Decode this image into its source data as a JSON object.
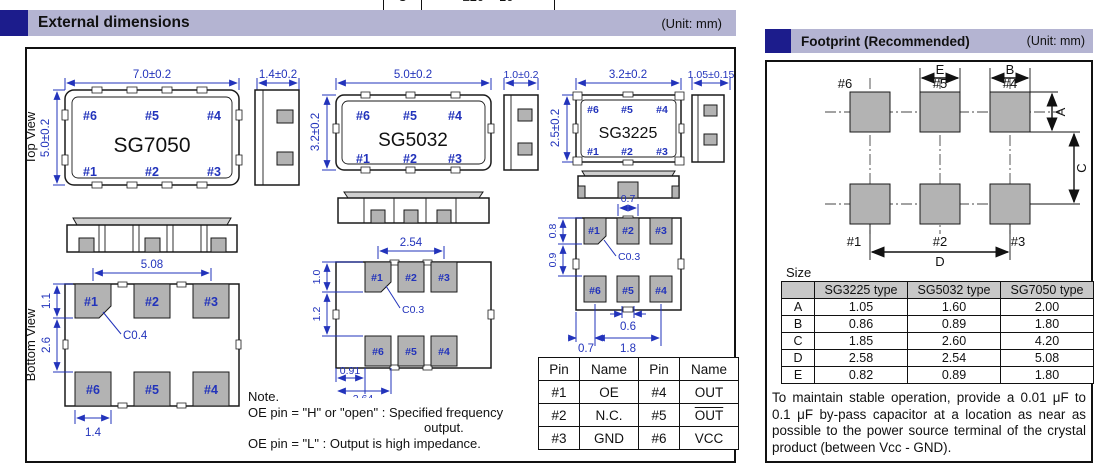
{
  "frag": {
    "c1": "C",
    "c2": "±20 × 10"
  },
  "ext": {
    "title": "External dimensions",
    "unit": "(Unit: mm)",
    "top_view": "Top View",
    "bottom_view": "Bottom View",
    "sg7050": {
      "name": "SG7050",
      "w": "7.0±0.2",
      "h": "5.0±0.2",
      "side": "1.4±0.2",
      "pins_top": [
        "#6",
        "#5",
        "#4"
      ],
      "pins_bot": [
        "#1",
        "#2",
        "#3"
      ],
      "bv": {
        "pitch": "5.08",
        "pad_h": "1.1",
        "gap": "2.6",
        "pad_w": "1.4",
        "chamfer": "C0.4",
        "row1": [
          "#1",
          "#2",
          "#3"
        ],
        "row2": [
          "#6",
          "#5",
          "#4"
        ]
      }
    },
    "sg5032": {
      "name": "SG5032",
      "w": "5.0±0.2",
      "h": "3.2±0.2",
      "side": "1.0±0.2",
      "pins_top": [
        "#6",
        "#5",
        "#4"
      ],
      "pins_bot": [
        "#1",
        "#2",
        "#3"
      ],
      "bv": {
        "pitch": "2.54",
        "pad_h": "1.0",
        "gap": "1.2",
        "d1": "0.91",
        "d2": "2.64",
        "chamfer": "C0.3",
        "row1": [
          "#1",
          "#2",
          "#3"
        ],
        "row2": [
          "#6",
          "#5",
          "#4"
        ]
      }
    },
    "sg3225": {
      "name": "SG3225",
      "w": "3.2±0.2",
      "h": "2.5±0.2",
      "side": "1.05±0.15",
      "pins_top": [
        "#6",
        "#5",
        "#4"
      ],
      "pins_bot": [
        "#1",
        "#2",
        "#3"
      ],
      "bv": {
        "notch_top": "0.7",
        "pad_h": "0.8",
        "gap": "0.9",
        "chamfer": "C0.3",
        "notch_bot": "0.6",
        "d_left": "0.7",
        "d_right": "1.8",
        "row1": [
          "#1",
          "#2",
          "#3"
        ],
        "row2": [
          "#6",
          "#5",
          "#4"
        ]
      }
    },
    "note": {
      "l1": "Note.",
      "l2": "OE pin = \"H\" or \"open\" : Specified frequency",
      "l3": "output.",
      "l4": "OE pin = \"L\" : Output is high impedance."
    },
    "pin_table": {
      "headers": [
        "Pin",
        "Name",
        "Pin",
        "Name"
      ],
      "rows": [
        [
          "#1",
          "OE",
          "#4",
          "OUT"
        ],
        [
          "#2",
          "N.C.",
          "#5",
          "OUT"
        ],
        [
          "#3",
          "GND",
          "#6",
          "VCC"
        ]
      ]
    }
  },
  "fp": {
    "title": "Footprint (Recommended)",
    "unit": "(Unit: mm)",
    "pads_top": [
      "#6",
      "#5",
      "#4"
    ],
    "pads_bot": [
      "#1",
      "#2",
      "#3"
    ],
    "dims": {
      "a": "A",
      "b": "B",
      "c": "C",
      "d": "D",
      "e": "E"
    },
    "size_label": "Size",
    "table": {
      "headers": [
        "",
        "SG3225 type",
        "SG5032 type",
        "SG7050 type"
      ],
      "rows": [
        [
          "A",
          "1.05",
          "1.60",
          "2.00"
        ],
        [
          "B",
          "0.86",
          "0.89",
          "1.80"
        ],
        [
          "C",
          "1.85",
          "2.60",
          "4.20"
        ],
        [
          "D",
          "2.58",
          "2.54",
          "5.08"
        ],
        [
          "E",
          "0.82",
          "0.89",
          "1.80"
        ]
      ]
    },
    "note": "To maintain stable operation, provide a 0.01 μF to 0.1 μF by-pass capacitor at a location as near as possible to the power source terminal of the crystal product (between Vcc - GND)."
  }
}
